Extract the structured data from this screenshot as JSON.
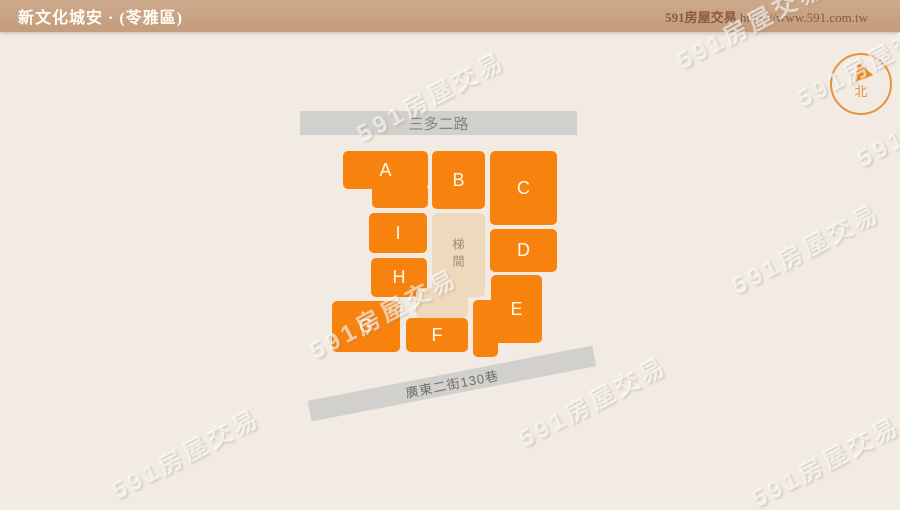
{
  "header": {
    "title": "新文化城安 · (苓雅區)",
    "brand": "591房屋交易",
    "url": "https://www.591.com.tw"
  },
  "compass": {
    "north_label": "北"
  },
  "roads": {
    "top_road": "三多二路",
    "bottom_road": "廣東二街130巷"
  },
  "stairwell": {
    "label": "梯間"
  },
  "blocks": [
    {
      "label": "A"
    },
    {
      "label": "B"
    },
    {
      "label": "C"
    },
    {
      "label": "D"
    },
    {
      "label": "E"
    },
    {
      "label": "F"
    },
    {
      "label": "G"
    },
    {
      "label": "H"
    },
    {
      "label": "I"
    }
  ],
  "watermark": {
    "text": "591房屋交易"
  },
  "colors": {
    "block_orange": "#f8820e",
    "stairwell_beige": "#eed9bc",
    "road_gray": "#d2d0cd",
    "header_tan": "#c7a183",
    "background_cream": "#f2ebe3",
    "compass_orange": "#e5913e"
  }
}
